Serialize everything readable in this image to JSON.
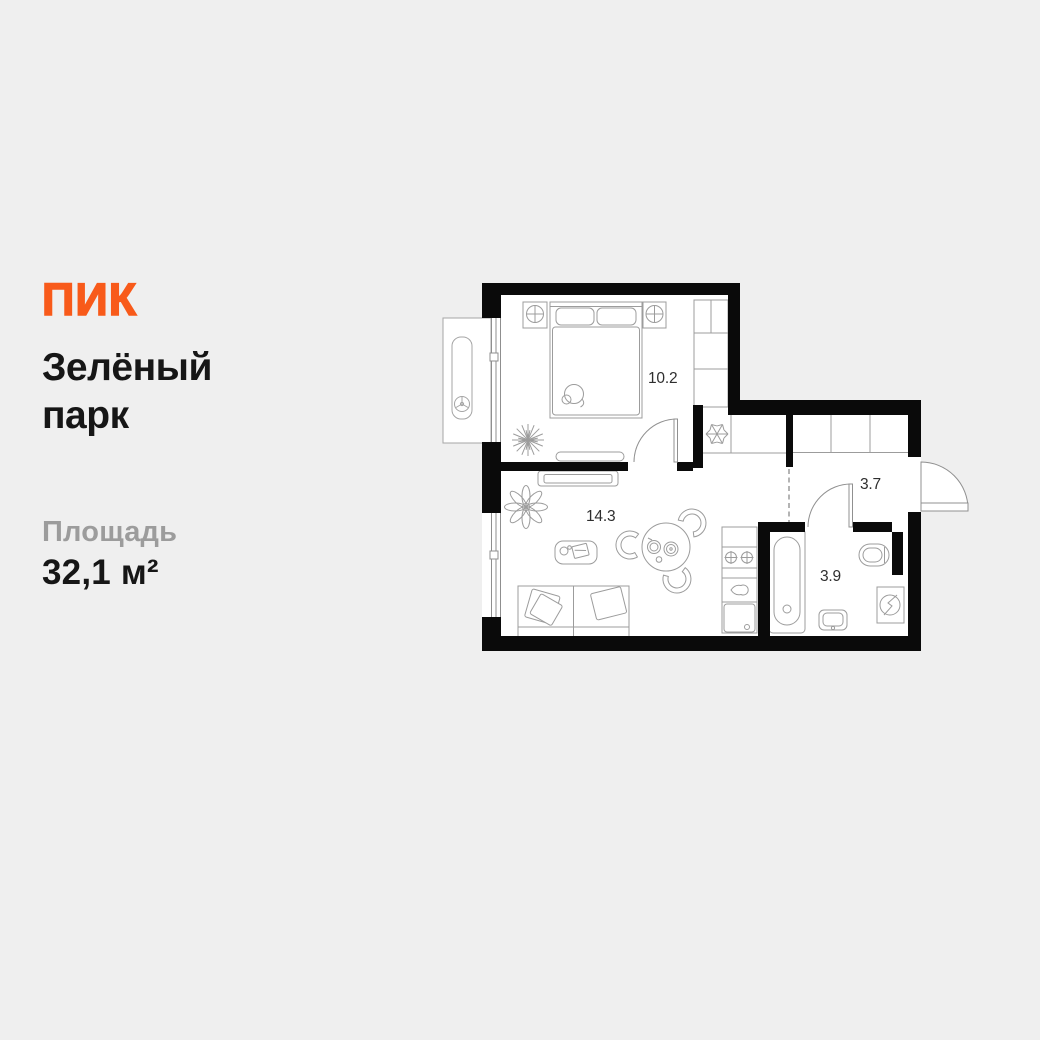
{
  "page": {
    "background": "#EFEFEF"
  },
  "brand": {
    "logo_text": "ПИК",
    "color": "#F85A1A"
  },
  "listing": {
    "project_name_line1": "Зелёный",
    "project_name_line2": "парк",
    "area_label": "Площадь",
    "area_value": "32,1 м²"
  },
  "floorplan": {
    "wall_color": "#0A0A0A",
    "line_color": "#9C9C9C",
    "room_labels": {
      "bedroom": "10.2",
      "living_room": "14.3",
      "hallway": "3.7",
      "bathroom": "3.9"
    }
  }
}
